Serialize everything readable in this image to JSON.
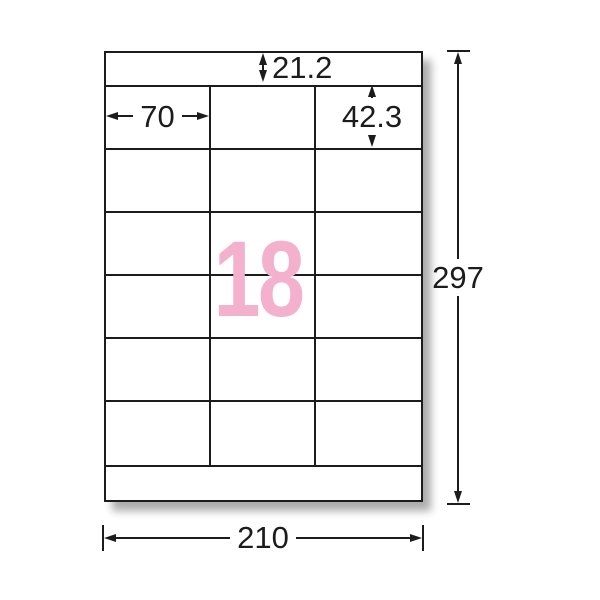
{
  "diagram": {
    "big_number": "18",
    "dims": {
      "top_margin": "21.2",
      "label_width": "70",
      "label_height": "42.3",
      "sheet_height": "297",
      "sheet_width": "210"
    },
    "grid": {
      "columns": 3,
      "rows": 6
    },
    "colors": {
      "accent_pink": "#F3B1CD",
      "line": "#1c1c1c"
    }
  }
}
